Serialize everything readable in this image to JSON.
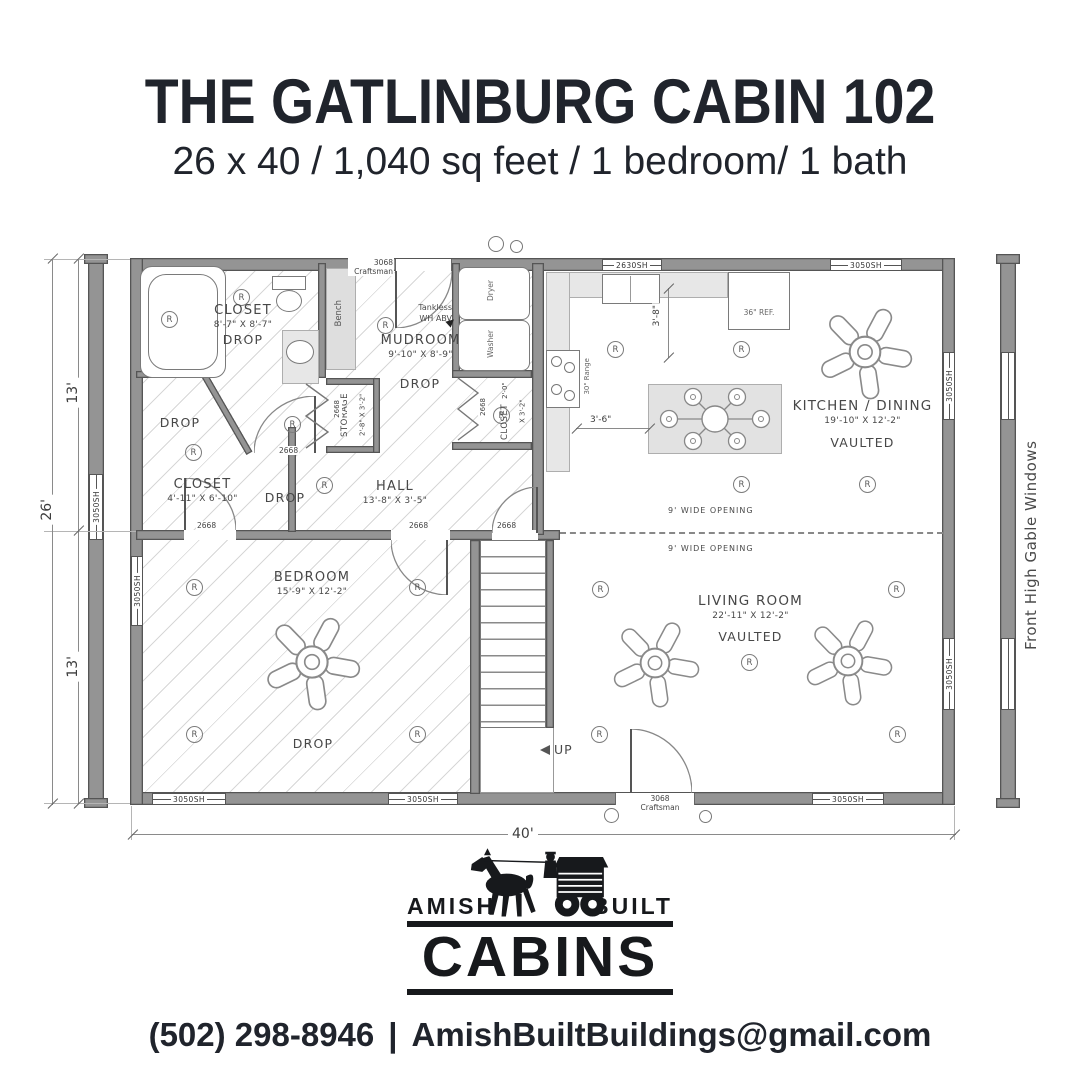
{
  "title": "THE GATLINBURG CABIN 102",
  "subtitle": "26 x 40 / 1,040 sq feet / 1 bedroom/ 1 bath",
  "plan": {
    "note_right": "Front High Gable Windows",
    "dims": {
      "width_total": "40'",
      "depth_total": "26'",
      "depth_upper": "13'",
      "depth_lower": "13'",
      "counter_to_island": "3'-6\"",
      "counter_run": "3'-8\""
    },
    "labels": {
      "window_3050": "3050SH",
      "window_2630": "2630SH",
      "door_3068_num": "3068",
      "door_3068_type": "Craftsman",
      "door_2668": "2668",
      "bench": "Bench",
      "washer": "Washer",
      "dryer": "Dryer",
      "tankless_1": "Tankless",
      "tankless_2": "WH ABV",
      "fridge": "36\" REF.",
      "range": "30\" Range",
      "wide_opening": "9' WIDE OPENING",
      "up": "UP",
      "recessed": "R"
    },
    "rooms": {
      "bath": {
        "name": "CLOSET",
        "size": "8'-7\" X 8'-7\"",
        "ceiling": "DROP"
      },
      "closet": {
        "name": "CLOSET",
        "size": "4'-11\" X 6'-10\"",
        "ceiling": "DROP"
      },
      "mudroom": {
        "name": "MUDROOM",
        "size": "9'-10\" X 8'-9\"",
        "ceiling": "DROP"
      },
      "storage": {
        "name": "STORAGE",
        "size": "2'-8\" X 3'-2\""
      },
      "laundry_closet": {
        "name": "CLOSET",
        "size": "2'-0\" X 3'-2\""
      },
      "hall": {
        "name": "HALL",
        "size": "13'-8\" X 3'-5\"",
        "ceiling": "DROP"
      },
      "kitchen": {
        "name": "KITCHEN / DINING",
        "size": "19'-10\" X 12'-2\"",
        "ceiling": "VAULTED"
      },
      "living": {
        "name": "LIVING ROOM",
        "size": "22'-11\" X 12'-2\"",
        "ceiling": "VAULTED"
      },
      "bedroom": {
        "name": "BEDROOM",
        "size": "15'-9\" X 12'-2\"",
        "ceiling": "DROP"
      }
    }
  },
  "logo": {
    "amish": "AMISH",
    "built": "BUILT",
    "cabins": "CABINS"
  },
  "footer": {
    "phone": "(502) 298-8946",
    "separator": "|",
    "email": "AmishBuiltBuildings@gmail.com"
  },
  "colors": {
    "ink": "#20242c",
    "wall": "#949494",
    "hatch": "#d7d7d7"
  }
}
